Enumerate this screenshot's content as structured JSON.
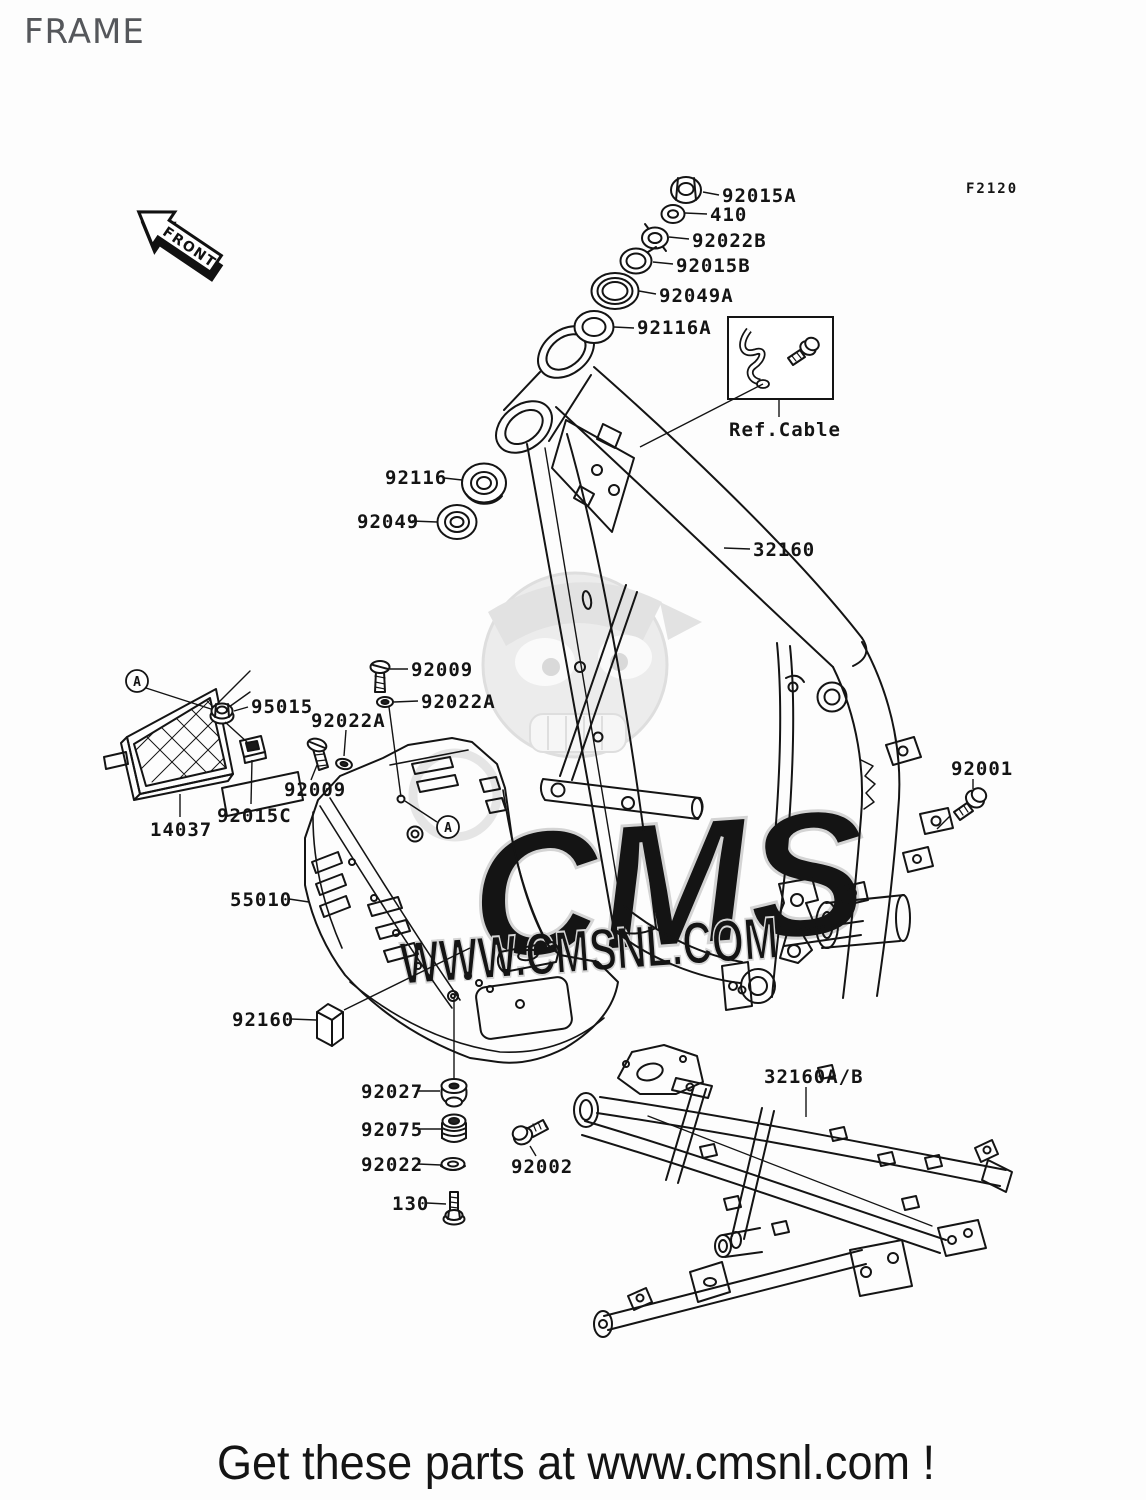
{
  "header": {
    "title": "FRAME",
    "figure_code": "F2120"
  },
  "orientation": {
    "front_label": "FRONT"
  },
  "detail_marker": "A",
  "ref_cable": {
    "label": "Ref.Cable"
  },
  "watermark": {
    "brand": "CMS",
    "url": "WWW.CMSNL.COM"
  },
  "footer": {
    "message": "Get these parts at www.cmsnl.com !",
    "color": "#cc0000"
  },
  "labels": {
    "l92015A": "92015A",
    "l410": "410",
    "l92022B": "92022B",
    "l92015B": "92015B",
    "l92049A": "92049A",
    "l92116A": "92116A",
    "l92116": "92116",
    "l92049": "92049",
    "l32160": "32160",
    "l92009_top": "92009",
    "l92022A_top": "92022A",
    "l95015": "95015",
    "l92022A_left": "92022A",
    "l92009_left": "92009",
    "l92015C": "92015C",
    "l14037": "14037",
    "l55010": "55010",
    "l92001": "92001",
    "l92160": "92160",
    "l92027": "92027",
    "l92075": "92075",
    "l92022": "92022",
    "l130": "130",
    "l92002": "92002",
    "l32160AB": "32160A/B"
  }
}
